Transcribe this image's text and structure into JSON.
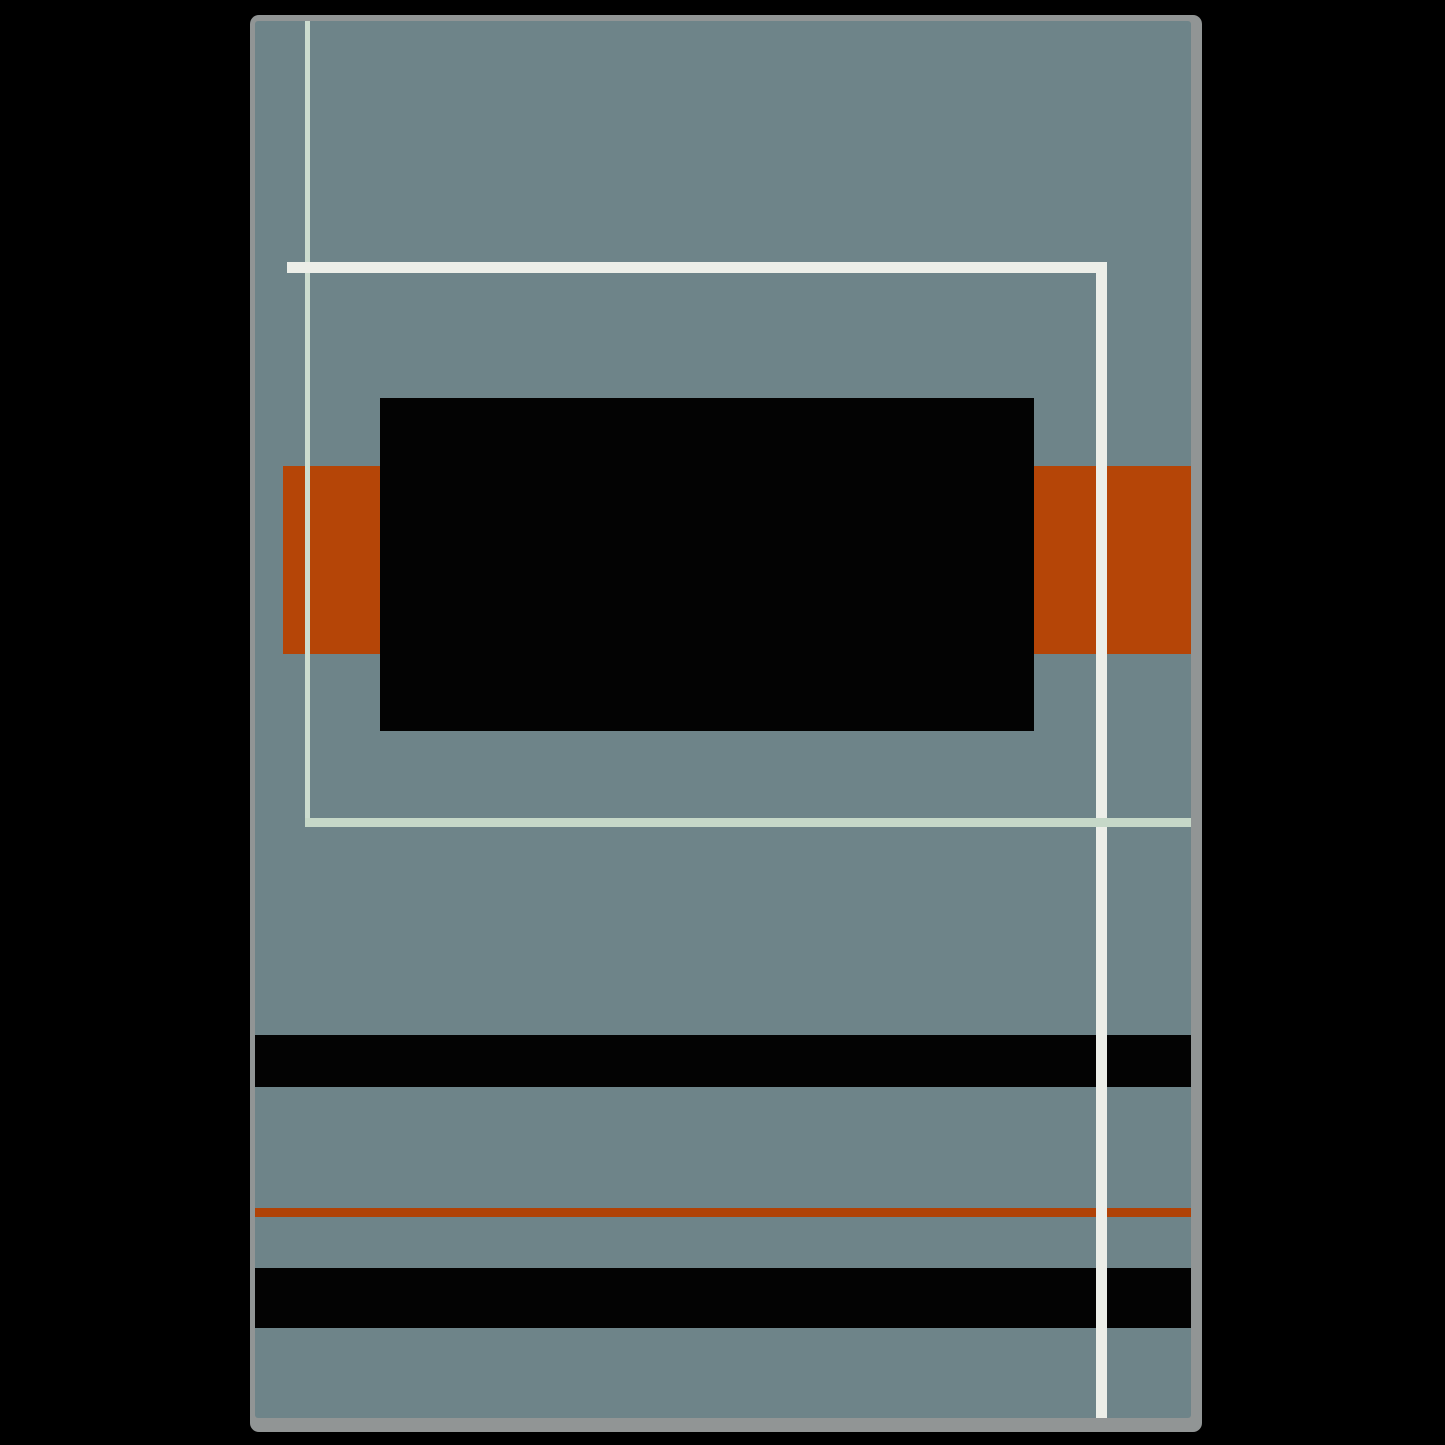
{
  "artwork": {
    "description": "Abstract geometric art print mockup: blue-gray canvas with black rectangle, rust-orange band, crossing mint and off-white lines, horizontal black stripes and a thin orange rule",
    "page_background_color": "#000000",
    "frame": {
      "x": 250,
      "y": 15,
      "width": 952,
      "height": 1417,
      "frame_color": "#919595",
      "canvas_color": "#6e8489",
      "canvas_offset_left": 5,
      "canvas_offset_top": 6,
      "canvas_width": 936,
      "canvas_height": 1397
    },
    "colors": {
      "canvas_blue_gray": "#6e8489",
      "rust_orange": "#b54507",
      "black": "#030303",
      "mint_line": "#ccdccf",
      "off_white_line": "#eceee8",
      "frame_gray": "#919595"
    },
    "shapes": [
      {
        "name": "orange-band",
        "x": 28,
        "y": 445,
        "w": 908,
        "h": 188,
        "color": "#b54507",
        "z": 1
      },
      {
        "name": "black-rectangle",
        "x": 125,
        "y": 377,
        "w": 654,
        "h": 333,
        "color": "#030303",
        "z": 2
      },
      {
        "name": "black-stripe-upper",
        "x": 0,
        "y": 1014,
        "w": 936,
        "h": 52,
        "color": "#030303",
        "z": 2
      },
      {
        "name": "orange-thin-rule",
        "x": 0,
        "y": 1187,
        "w": 936,
        "h": 9,
        "color": "#b04206",
        "z": 2
      },
      {
        "name": "black-stripe-lower",
        "x": 0,
        "y": 1247,
        "w": 936,
        "h": 60,
        "color": "#030303",
        "z": 2
      },
      {
        "name": "mint-vertical-line",
        "x": 50,
        "y": 0,
        "w": 5,
        "h": 806,
        "color": "#ccdccf",
        "z": 3
      },
      {
        "name": "white-horizontal-line",
        "x": 32,
        "y": 241,
        "w": 820,
        "h": 11,
        "color": "#eceee8",
        "z": 4
      },
      {
        "name": "white-vertical-line",
        "x": 841,
        "y": 241,
        "w": 11,
        "h": 1156,
        "color": "#eceee8",
        "z": 4
      },
      {
        "name": "mint-horizontal-line",
        "x": 50,
        "y": 797,
        "w": 886,
        "h": 9,
        "color": "#c6d8c8",
        "z": 5
      }
    ]
  }
}
